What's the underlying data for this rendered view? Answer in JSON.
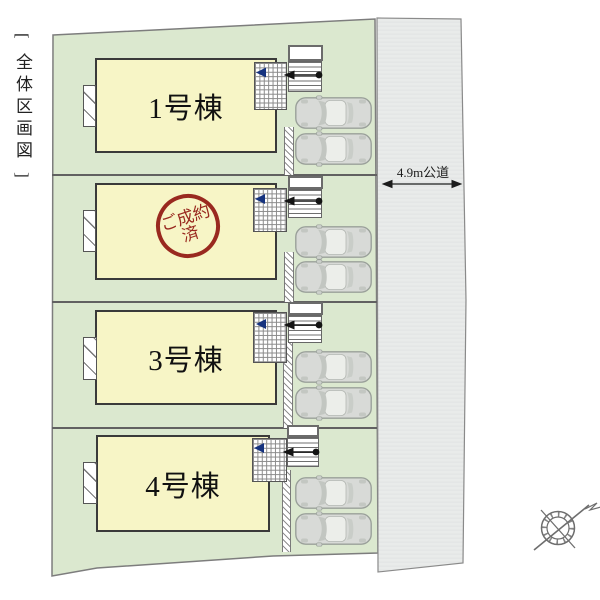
{
  "diagram": {
    "title": "[ 全体区画図 ]",
    "road": {
      "label": "4.9m公道"
    },
    "plots": [
      {
        "id": "1",
        "label": "1号棟",
        "stamp": null,
        "parked_cars": 2
      },
      {
        "id": "2",
        "label": "",
        "stamp": {
          "line1": "ご成約",
          "line2": "済"
        },
        "parked_cars": 2
      },
      {
        "id": "3",
        "label": "3号棟",
        "stamp": null,
        "parked_cars": 2
      },
      {
        "id": "4",
        "label": "4号棟",
        "stamp": null,
        "parked_cars": 2
      }
    ],
    "icons": {
      "compass": "compass-rose-icon",
      "entrance_marker": "left-triangle-icon",
      "approach_arrow": "left-arrow-with-dot-icon"
    },
    "colors": {
      "site_green": "#dbe8cf",
      "building_yellow": "#f7f5c6",
      "stamp_red": "#99291f",
      "entrance_marker_blue": "#16337f",
      "road_gray": "#e9ebea",
      "line_gray": "#616161"
    }
  }
}
